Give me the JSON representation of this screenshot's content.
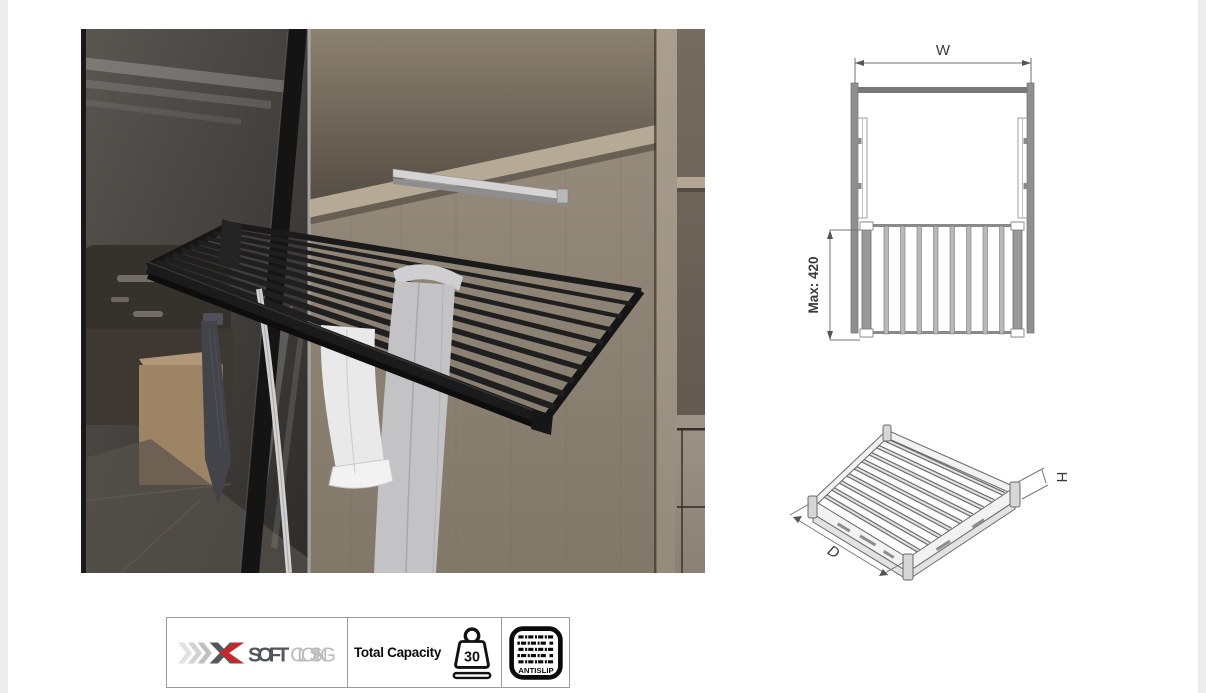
{
  "diagrams": {
    "front_view": {
      "width_label": "W",
      "max_depth_label": "Max: 420"
    },
    "iso_view": {
      "depth_label": "D",
      "height_label": "H"
    }
  },
  "badges": {
    "soft_closing": {
      "soft": "SOFT",
      "closing": "CLOSING"
    },
    "capacity": {
      "label": "Total Capacity",
      "value": "30"
    },
    "antislip": {
      "label": "ANTISLIP"
    }
  },
  "colors": {
    "accent_red": "#c9252b",
    "logo_dark": "#53575c",
    "logo_light": "#bcbcbc",
    "drawing_line": "#6f6f6f",
    "dim_text": "#3a3a3a",
    "rack_black": "#1a1a1a"
  }
}
